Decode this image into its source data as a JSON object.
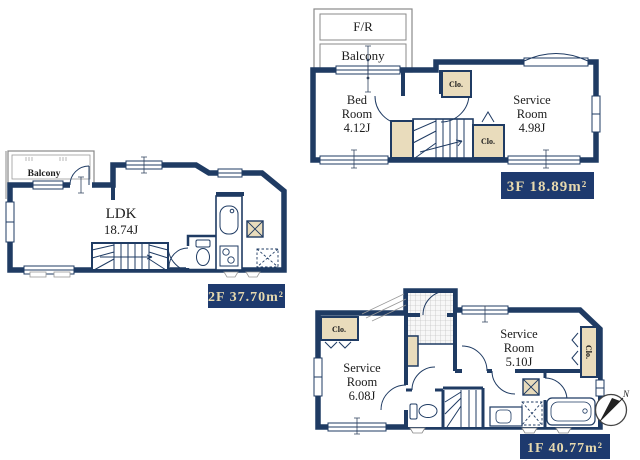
{
  "colors": {
    "wall_navy": "#1f3b63",
    "closet_beige": "#e9dcbc",
    "label_bg_navy": "#1e3a6e",
    "label_text_cream": "#e7d9ae",
    "floor_fill": "#f2f1ee"
  },
  "plans": {
    "f3": {
      "fr_label": "F/R",
      "balcony_label": "Balcony",
      "bedroom": {
        "line1": "Bed",
        "line2": "Room",
        "area": "4.12J"
      },
      "service": {
        "line1": "Service",
        "line2": "Room",
        "area": "4.98J"
      },
      "closet_top": "Clo.",
      "closet_bottom": "Clo.",
      "floor_label": "3F 18.89m²"
    },
    "f2": {
      "balcony_label": "Balcony",
      "ldk": {
        "line1": "LDK",
        "area": "18.74J"
      },
      "floor_label": "2F 37.70m²"
    },
    "f1": {
      "closet_left": "Clo.",
      "closet_right": "Clo.",
      "service_left": {
        "line1": "Service",
        "line2": "Room",
        "area": "6.08J"
      },
      "service_right": {
        "line1": "Service",
        "line2": "Room",
        "area": "5.10J"
      },
      "floor_label": "1F 40.77m²"
    },
    "compass": {
      "north": "N"
    }
  }
}
